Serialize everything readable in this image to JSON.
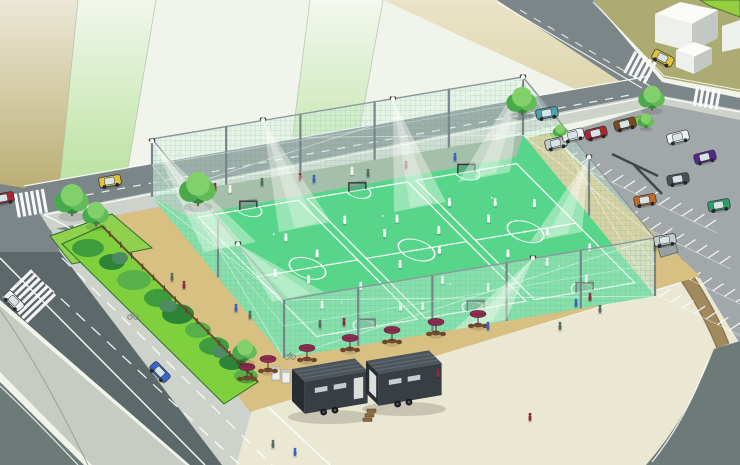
{
  "meta": {
    "description": "Aerial isometric illustration of a fenced three-court futsal sports facility with floodlights, surrounded by roads, crosswalks, a parking lot with cars, hedges, trees, food trailers and cafe umbrellas"
  },
  "palette": {
    "paper": "#f0f4ea",
    "fieldKhaki": "#b6a96b",
    "fieldGreen": "#bce3a2",
    "backTan": "#ded6ae",
    "blockKhaki": "#abab72",
    "grassCorner": "#97ce3f",
    "road": "#7c8689",
    "roadDark": "#5d686a",
    "median": "#c6ccc4",
    "cornerRoad": "#6e7a78",
    "sidewalk": "#cdd2cb",
    "parking": "#a2a8a9",
    "plaza": "#eae7d2",
    "siteTan": "#d8c083",
    "pathTan": "#a18a5e",
    "court": "#57d68b",
    "courtLine": "#ffffff",
    "walkway": "#a4bfaa",
    "hedge": "#7ed13c",
    "island": "#8fd14e",
    "trunk": "#7b5a38",
    "netFill": "rgba(208,242,223,0.38)",
    "netLine": "rgba(90,130,110,0.28)",
    "pole": "#79848a",
    "rail": "#8d979b",
    "lightCone": "rgba(255,255,248,0.38)",
    "trailerSide": "#373e44",
    "trailerEnd": "#282d32",
    "trailerTop": "#4c545c",
    "trailerDoor": "#dcdedc",
    "umbrella": "#8e2d4e",
    "tableBrown": "#6f482c",
    "buildingTop": "#fbfcfa",
    "buildingFront": "#eef0ec",
    "buildingSide": "#c3c8c4",
    "treeDark": "#2f8a3a",
    "treeMid": "#4aa94c",
    "treeLight": "#63bb58",
    "treePale": "#82d06a",
    "carColors": {
      "yellow": "#e2c23a",
      "teal": "#4aa3ad",
      "blue": "#3a66c9",
      "red": "#ae2630",
      "white": "#f2f2f2",
      "silver": "#c6ccce",
      "brown": "#7a4a21",
      "purple": "#55268c",
      "green": "#2f9e68",
      "orange": "#bf6c2a",
      "darkgrey": "#4b5157"
    },
    "bushColors": [
      "#3f9c3c",
      "#2e8436",
      "#57b04a",
      "#4e8a63"
    ],
    "peopleColors": [
      "#3b62b5",
      "#8a2d3e",
      "#f5f5f5",
      "#5a6b5d",
      "#caa84a",
      "#3e8d6a"
    ]
  },
  "scene": {
    "courts": {
      "count": 3
    },
    "players": [
      [
        0.06,
        0.52
      ],
      [
        0.13,
        0.6
      ],
      [
        0.1,
        0.78
      ],
      [
        0.22,
        0.44
      ],
      [
        0.25,
        0.7
      ],
      [
        0.18,
        0.3
      ],
      [
        0.3,
        0.88
      ],
      [
        0.38,
        0.25
      ],
      [
        0.45,
        0.38
      ],
      [
        0.52,
        0.3
      ],
      [
        0.41,
        0.6
      ],
      [
        0.48,
        0.75
      ],
      [
        0.55,
        0.55
      ],
      [
        0.6,
        0.42
      ],
      [
        0.58,
        0.85
      ],
      [
        0.36,
        0.9
      ],
      [
        0.7,
        0.25
      ],
      [
        0.76,
        0.4
      ],
      [
        0.82,
        0.3
      ],
      [
        0.72,
        0.65
      ],
      [
        0.8,
        0.75
      ],
      [
        0.88,
        0.55
      ],
      [
        0.92,
        0.35
      ],
      [
        0.86,
        0.9
      ],
      [
        0.95,
        0.7
      ]
    ],
    "walkway_people": [
      [
        200,
        197,
        0
      ],
      [
        215,
        191,
        1
      ],
      [
        230,
        193,
        2
      ],
      [
        262,
        186,
        3
      ],
      [
        300,
        181,
        1
      ],
      [
        314,
        183,
        0
      ],
      [
        352,
        175,
        2
      ],
      [
        368,
        177,
        3
      ],
      [
        406,
        169,
        1
      ],
      [
        455,
        161,
        0
      ]
    ],
    "ground_people": [
      [
        172,
        281,
        3
      ],
      [
        184,
        289,
        1
      ],
      [
        236,
        312,
        0
      ],
      [
        250,
        319,
        3
      ],
      [
        273,
        448,
        3
      ],
      [
        295,
        456,
        0
      ],
      [
        438,
        377,
        1
      ],
      [
        560,
        330,
        3
      ],
      [
        576,
        307,
        0
      ],
      [
        590,
        301,
        1
      ],
      [
        600,
        313,
        3
      ],
      [
        655,
        250,
        3
      ],
      [
        530,
        421,
        1
      ],
      [
        488,
        330,
        0
      ],
      [
        320,
        328,
        3
      ],
      [
        344,
        326,
        1
      ]
    ],
    "umbrellas": [
      [
        247,
        380
      ],
      [
        268,
        372
      ],
      [
        307,
        361
      ],
      [
        350,
        351
      ],
      [
        392,
        343
      ],
      [
        436,
        335
      ],
      [
        478,
        327
      ]
    ],
    "trees": [
      [
        72,
        200,
        17
      ],
      [
        96,
        214,
        13
      ],
      [
        198,
        189,
        18
      ],
      [
        245,
        351,
        12
      ],
      [
        522,
        101,
        15
      ],
      [
        652,
        98,
        13
      ],
      [
        560,
        131,
        7
      ],
      [
        646,
        121,
        8
      ]
    ],
    "bicycles": [
      [
        133,
        317
      ],
      [
        290,
        357
      ]
    ],
    "vending_machines": [
      [
        276,
        380
      ],
      [
        286,
        383
      ]
    ],
    "floodlights": [
      [
        152,
        141,
        230,
        252
      ],
      [
        263,
        120,
        305,
        232
      ],
      [
        393,
        99,
        420,
        212
      ],
      [
        238,
        244,
        298,
        302
      ],
      [
        533,
        258,
        480,
        330
      ],
      [
        589,
        157,
        556,
        242
      ],
      [
        523,
        77,
        484,
        182
      ]
    ],
    "crosswalks": [
      [
        32,
        203,
        -10,
        6,
        24
      ],
      [
        30,
        297,
        46,
        7,
        40
      ],
      [
        641,
        68,
        28,
        5,
        24
      ],
      [
        708,
        98,
        10,
        5,
        20
      ]
    ],
    "parking_rows": [
      [
        566,
        160,
        13
      ],
      [
        592,
        202,
        12
      ],
      [
        620,
        246,
        11
      ],
      [
        648,
        291,
        8
      ]
    ],
    "cars": [
      [
        110,
        181,
        -10,
        "yellow"
      ],
      [
        547,
        113,
        -10,
        "teal"
      ],
      [
        663,
        58,
        28,
        "yellow"
      ],
      [
        160,
        372,
        46,
        "blue"
      ],
      [
        14,
        301,
        46,
        "white"
      ],
      [
        3,
        198,
        -10,
        "red"
      ],
      [
        556,
        143,
        -14,
        "silver"
      ],
      [
        573,
        135,
        -14,
        "white"
      ],
      [
        596,
        133,
        -14,
        "red"
      ],
      [
        625,
        124,
        -14,
        "brown"
      ],
      [
        678,
        137,
        -14,
        "white"
      ],
      [
        705,
        157,
        -14,
        "purple"
      ],
      [
        678,
        179,
        -10,
        "darkgrey"
      ],
      [
        645,
        200,
        -10,
        "orange"
      ],
      [
        719,
        205,
        -10,
        "green"
      ],
      [
        665,
        240,
        -10,
        "silver"
      ]
    ],
    "hedge_bushes": [
      [
        88,
        248,
        16,
        9,
        0
      ],
      [
        112,
        262,
        13,
        8,
        1
      ],
      [
        134,
        280,
        17,
        10,
        2
      ],
      [
        158,
        298,
        14,
        9,
        0
      ],
      [
        178,
        314,
        16,
        10,
        1
      ],
      [
        198,
        330,
        13,
        8,
        2
      ],
      [
        214,
        346,
        15,
        9,
        0
      ],
      [
        232,
        362,
        13,
        8,
        1
      ],
      [
        246,
        376,
        12,
        7,
        2
      ],
      [
        120,
        258,
        8,
        6,
        3
      ],
      [
        168,
        306,
        9,
        6,
        3
      ],
      [
        220,
        352,
        8,
        6,
        3
      ]
    ]
  }
}
